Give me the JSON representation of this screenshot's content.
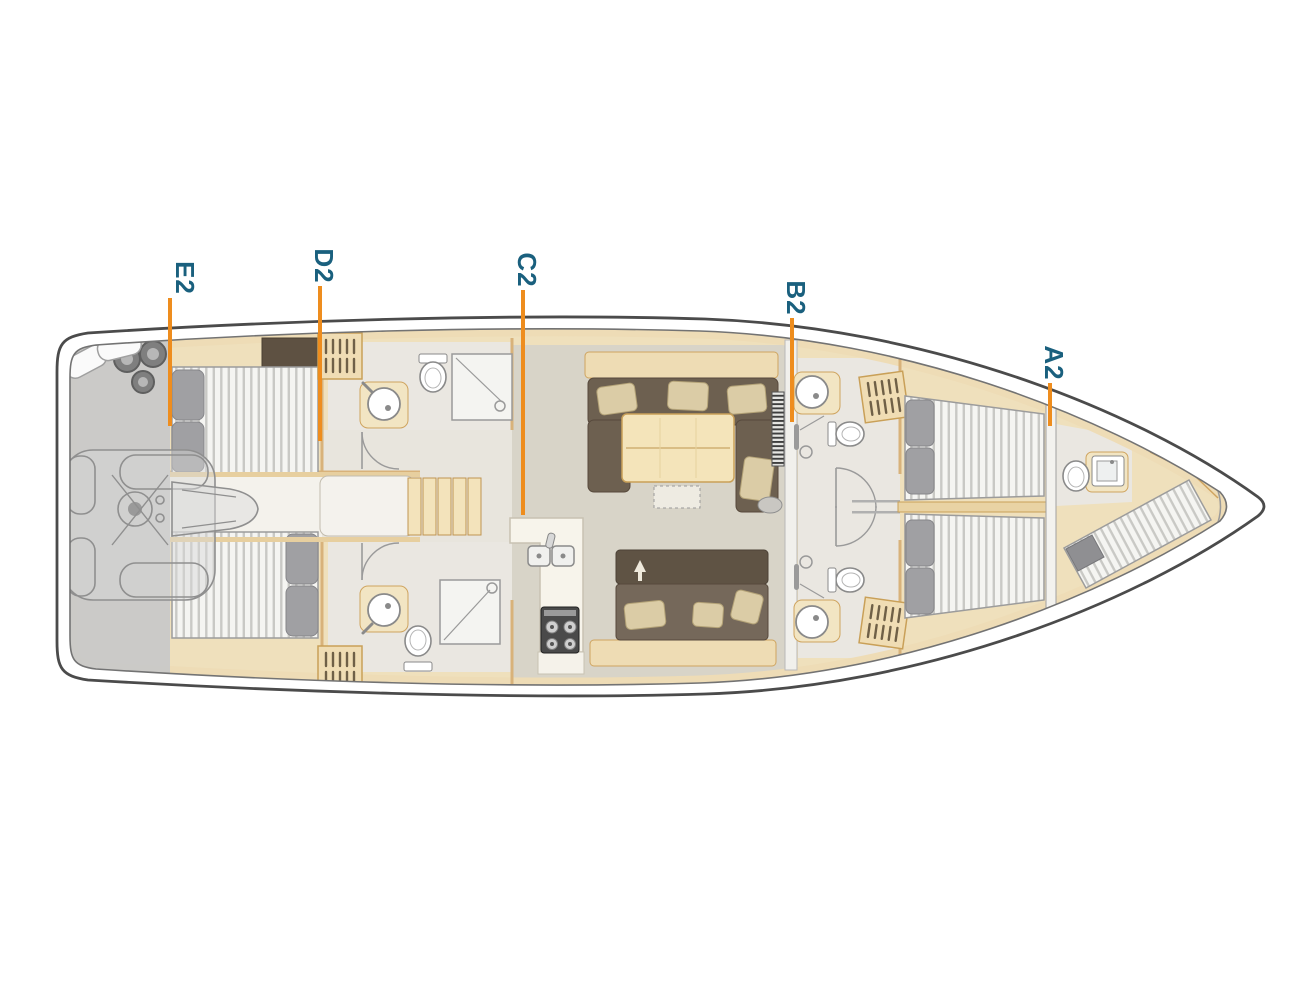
{
  "cabin_labels": [
    {
      "id": "E2",
      "text": "E2"
    },
    {
      "id": "D2",
      "text": "D2"
    },
    {
      "id": "C2",
      "text": "C2"
    },
    {
      "id": "B2",
      "text": "B2"
    },
    {
      "id": "A2",
      "text": "A2"
    }
  ],
  "colors": {
    "marker_line_orange": "#ee8d1e",
    "label_text_teal": "#1a607e",
    "hull_outline_gray": "#4b4b4b",
    "wood_tan": "#efe0bc",
    "upholstery_brown": "#6d6050",
    "cockpit_gray": "#c8c8c8"
  }
}
